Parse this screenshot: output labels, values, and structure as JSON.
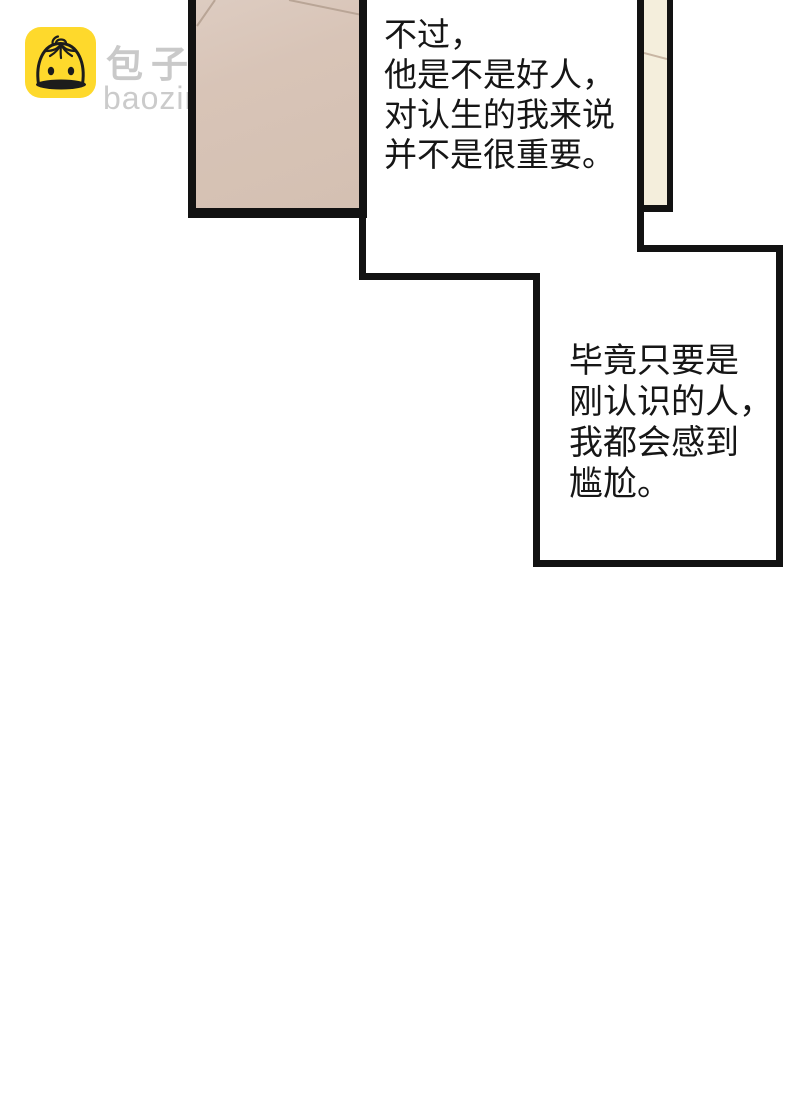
{
  "watermark": {
    "site_name": "包子漫畫",
    "site_url": "baozimh.com",
    "icon": "baozi-bun-icon",
    "icon_bg_color": "#FED92C",
    "icon_line_color": "#1C1C1C",
    "text_color": "#C9C9C9"
  },
  "panels": {
    "left_panel": {
      "description": "beige wall panel, cropped by top edge",
      "fill_color": "#D7C3B6",
      "outline_color": "#121212"
    },
    "right_panel": {
      "description": "narrow cream wall panel strip, cropped by top edge",
      "fill_color": "#F4EEDC",
      "outline_color": "#121212"
    }
  },
  "dialogue": {
    "monologue1": {
      "lines": [
        "不过，",
        "他是不是好人，",
        "对认生的我来说",
        "并不是很重要。"
      ],
      "text_color": "#161616"
    },
    "monologue2": {
      "lines": [
        "毕竟只要是",
        "刚认识的人，",
        "我都会感到",
        "尴尬。"
      ],
      "text_color": "#161616"
    }
  },
  "colors": {
    "page_background": "#FFFFFF",
    "speech_outline": "#121212",
    "wall_corner_line": "#B9A596"
  }
}
